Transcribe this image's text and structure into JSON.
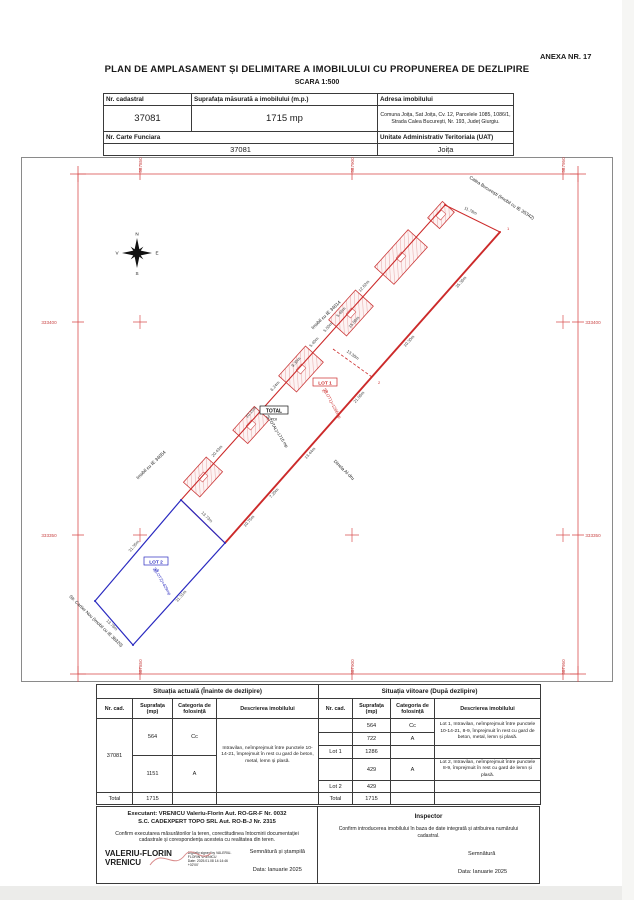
{
  "page": {
    "annex": "ANEXA NR. 17",
    "title": "PLAN DE AMPLASAMENT ȘI DELIMITARE A IMOBILULUI CU PROPUNEREA DE DEZLIPIRE",
    "scale": "SCARA 1:500"
  },
  "cadastral_table": {
    "h_nr_cadastral": "Nr. cadastral",
    "h_suprafata": "Suprafața măsurată a imobilului (m.p.)",
    "h_adresa": "Adresa imobilului",
    "nr_cadastral": "37081",
    "suprafata": "1715 mp",
    "adresa": "Comuna Joița, Sat Joița, Cv. 12, Parcelele 1085, 1086/1, Strada Calea București, Nr. 193, Județ Giurgiu.",
    "h_carte_funciara": "Nr. Carte Funciara",
    "h_uat": "Unitate Administrativ Teritoriala (UAT)",
    "carte_funciara": "37081",
    "uat": "Joița"
  },
  "map": {
    "grid": {
      "eastings": [
        "587850",
        "587900",
        "587950"
      ],
      "northings": [
        "333400",
        "333350"
      ]
    },
    "compass": {
      "n": "N",
      "s": "S",
      "e": "E",
      "v": "V"
    },
    "streets": {
      "calea": "Calea București (Imobil cu IE 35342)",
      "ie34014": "Imobil cu IE 34014",
      "ie34054": "Imobil cu IE 34054",
      "cartier": "Str. Cartier Nou (Imobil cu IE 38320)",
      "vecin": "Dinela Al-dru"
    },
    "lots": {
      "total": {
        "name": "TOTAL",
        "cat": "TDI",
        "area": "S(TOTAL)=1715 mp"
      },
      "lot1": {
        "name": "LOT 1",
        "cat": "TDI",
        "area": "S(LOT1)=1286mp"
      },
      "lot2": {
        "name": "LOT 2",
        "cat": "TDI",
        "area": "S(LOT2)=429mp"
      }
    },
    "points": {
      "p1": "1",
      "p2": "2"
    },
    "dims": [
      "20.43m",
      "10.15m",
      "6.24m",
      "9.30m",
      "5.40m",
      "5.50m",
      "5.46m",
      "12.62m",
      "15.06m",
      "11.78m",
      "35.36m",
      "10.30m",
      "21.06m",
      "13.44m",
      "7.20m",
      "10.75m",
      "13.38m",
      "31.35m",
      "13.73m",
      "31.31m",
      "13.76m"
    ]
  },
  "situatia_actuala": {
    "title": "Situația actuală (Înainte de dezlipire)",
    "h_nr": "Nr. cad.",
    "h_sup": "Suprafața (mp)",
    "h_cat": "Categoria de folosință",
    "h_desc": "Descrierea imobilului",
    "nr_cad": "37081",
    "r1_sup": "564",
    "r1_cat": "Cc",
    "r2_sup": "1151",
    "r2_cat": "A",
    "descriere": "Intravilan, neîmprejmuit între punctele 10-14-21, împrejmuit în rest cu gard de beton, metal, lemn și plasă.",
    "total_label": "Total",
    "total": "1715"
  },
  "situatia_viitoare": {
    "title": "Situația viitoare (După dezlipire)",
    "h_nr": "Nr. cad.",
    "h_sup": "Suprafața (mp)",
    "h_cat": "Categoria de folosință",
    "h_desc": "Descrierea imobilului",
    "r1_sup": "564",
    "r1_cat": "Cc",
    "r2_sup": "722",
    "r2_cat": "A",
    "desc1": "Lot 1, Intravilan, neîmprejmuit între punctele 10-14-21, 8-9, împrejmuit în rest cu gard de beton, metal, lemn și plasă.",
    "lot1_label": "Lot 1",
    "lot1_total": "1286",
    "r3_sup": "429",
    "r3_cat": "A",
    "desc2": "Lot 2, Intravilan, neîmprejmuit între punctele 8-9, împrejmuit în rest cu gard de lemn și plasă.",
    "lot2_label": "Lot 2",
    "lot2_total": "429",
    "total_label": "Total",
    "total": "1715"
  },
  "executant": {
    "line1": "Executant: VRENICU Valeriu-Florin Aut. RO-GR-F Nr. 0032",
    "line2": "S.C. CADEXPERT TOPO SRL Aut. RO-B-J Nr. 2315",
    "confirm": "Confirm executarea măsurătorilor la teren, corectitudinea întocmirii documentației cadastrale și corespondența acesteia cu realitatea din teren.",
    "sig_name1": "VALERIU-FLORIN",
    "sig_name2": "VRENICU",
    "sig_d1": "Digitally signed by VALERIU-",
    "sig_d2": "FLORIN VRENICU",
    "sig_d3": "Date: 2025.01.08 14:14:46",
    "sig_d4": "+02'00'",
    "right1": "Semnătură și ștampilă",
    "right2": "Data: Ianuarie 2025"
  },
  "inspector": {
    "title": "Inspector",
    "confirm": "Confirm introducerea imobilului în baza de date integrată și atribuirea numărului cadastral.",
    "sig": "Semnătură",
    "data": "Data: Ianuarie 2025"
  }
}
